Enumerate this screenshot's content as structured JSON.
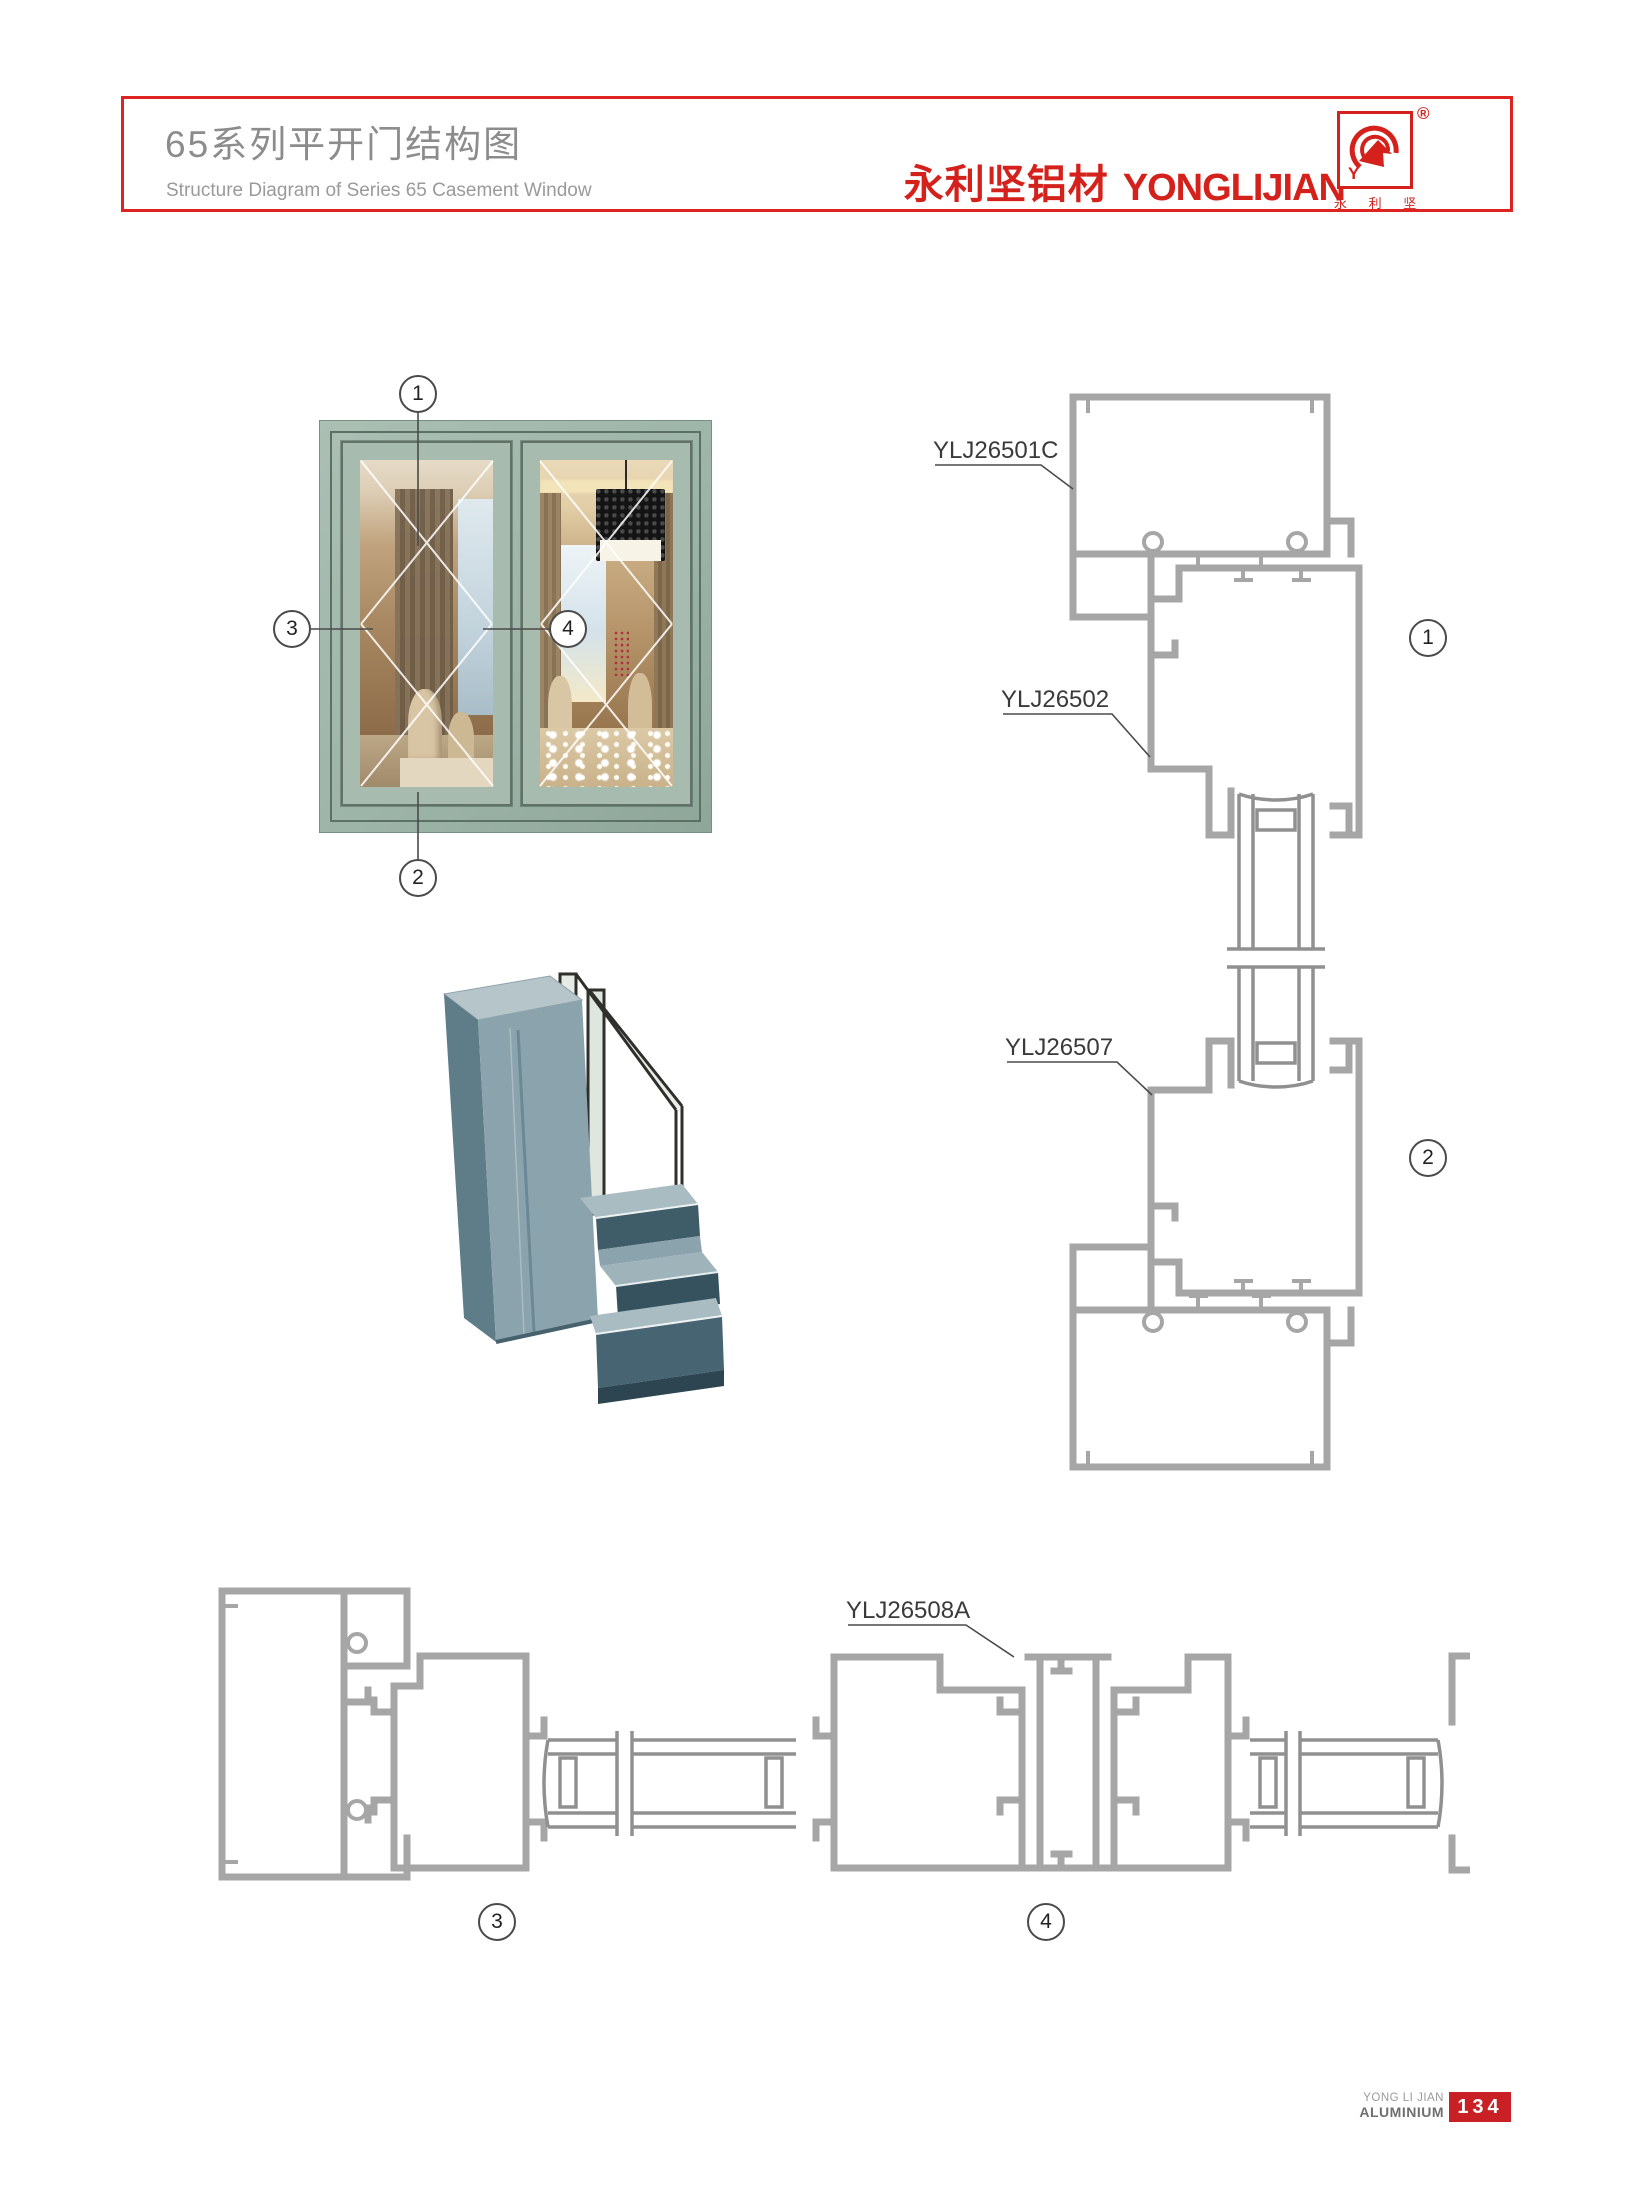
{
  "header": {
    "title_cn": "65系列平开门结构图",
    "title_en": "Structure Diagram of Series 65 Casement Window",
    "brand_cn": "永利坚铝材",
    "brand_en": "YONGLIJIAN",
    "registered": "®",
    "logo_caption": "永 利 坚",
    "logo_letter": "Y"
  },
  "window_callouts": [
    "1",
    "2",
    "3",
    "4"
  ],
  "vertical_section": {
    "part_labels": [
      {
        "code": "YLJ26501C"
      },
      {
        "code": "YLJ26502"
      },
      {
        "code": "YLJ26507"
      }
    ],
    "section_marks": [
      "1",
      "2"
    ]
  },
  "horizontal_section": {
    "part_label": "YLJ26508A",
    "section_marks": [
      "3",
      "4"
    ]
  },
  "footer": {
    "company_line1": "YONG LI JIAN",
    "company_line2": "ALUMINIUM",
    "page_number": "134"
  },
  "colors": {
    "accent_red": "#d5211c",
    "footer_red": "#c92026",
    "drawing_gray": "#a6a6a6",
    "window_frame_green": "#9db4a8"
  }
}
